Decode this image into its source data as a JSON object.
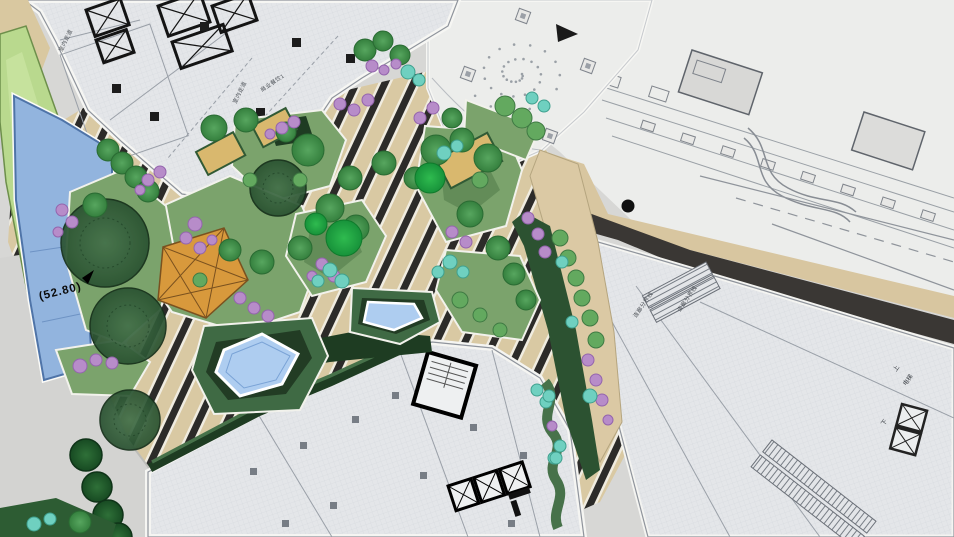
{
  "meta": {
    "type": "landscape-architecture-site-plan",
    "description": "Colored master plan of a podium roof garden plaza between CAD building floor plans"
  },
  "labels": {
    "elevation": "(52.80)",
    "room_commercial": "商业餐饮1",
    "corridor": "室内走道",
    "bridge_boundary": "连廊分界线",
    "elevator": "电梯",
    "up": "上",
    "down": "下"
  },
  "legend": [
    "striped plaza paving",
    "planting islands with trees",
    "flowering shrubs (purple)",
    "accent shrubs (cyan)",
    "water feature pools",
    "timber deck planters",
    "shade pavilion",
    "building floor plans",
    "elevated walkway",
    "retaining wall band",
    "street trees along road"
  ],
  "palette": {
    "canvas": "#d7d7d5",
    "paper": "#ecedeb",
    "building_fill": "#e4e6e9",
    "grid_line": "#d3d6db",
    "cad_line": "#9aa0a8",
    "stripe_tan": "#d9c9a3",
    "stripe_dark": "#2c2b29",
    "stripe_white": "#f0ece0",
    "path_tan": "#dbc9a4",
    "island_green": "#7ba36c",
    "island_dark": "#56804e",
    "hedge_dark": "#1e3c22",
    "tree_dark": "#2a5231",
    "tree_mid": "#35803e",
    "tree_bright": "#17923a",
    "shrub_purple": "#b78cc9",
    "shrub_cyan": "#6fd0c0",
    "planter_tan": "#d9b86e",
    "pavilion_orange": "#d8993c",
    "water": "#92b4de",
    "pool": "#aecdf0",
    "wall_dark": "#3a3734",
    "road_gray": "#d3d3d1",
    "slope_green": "#b9d98e"
  }
}
